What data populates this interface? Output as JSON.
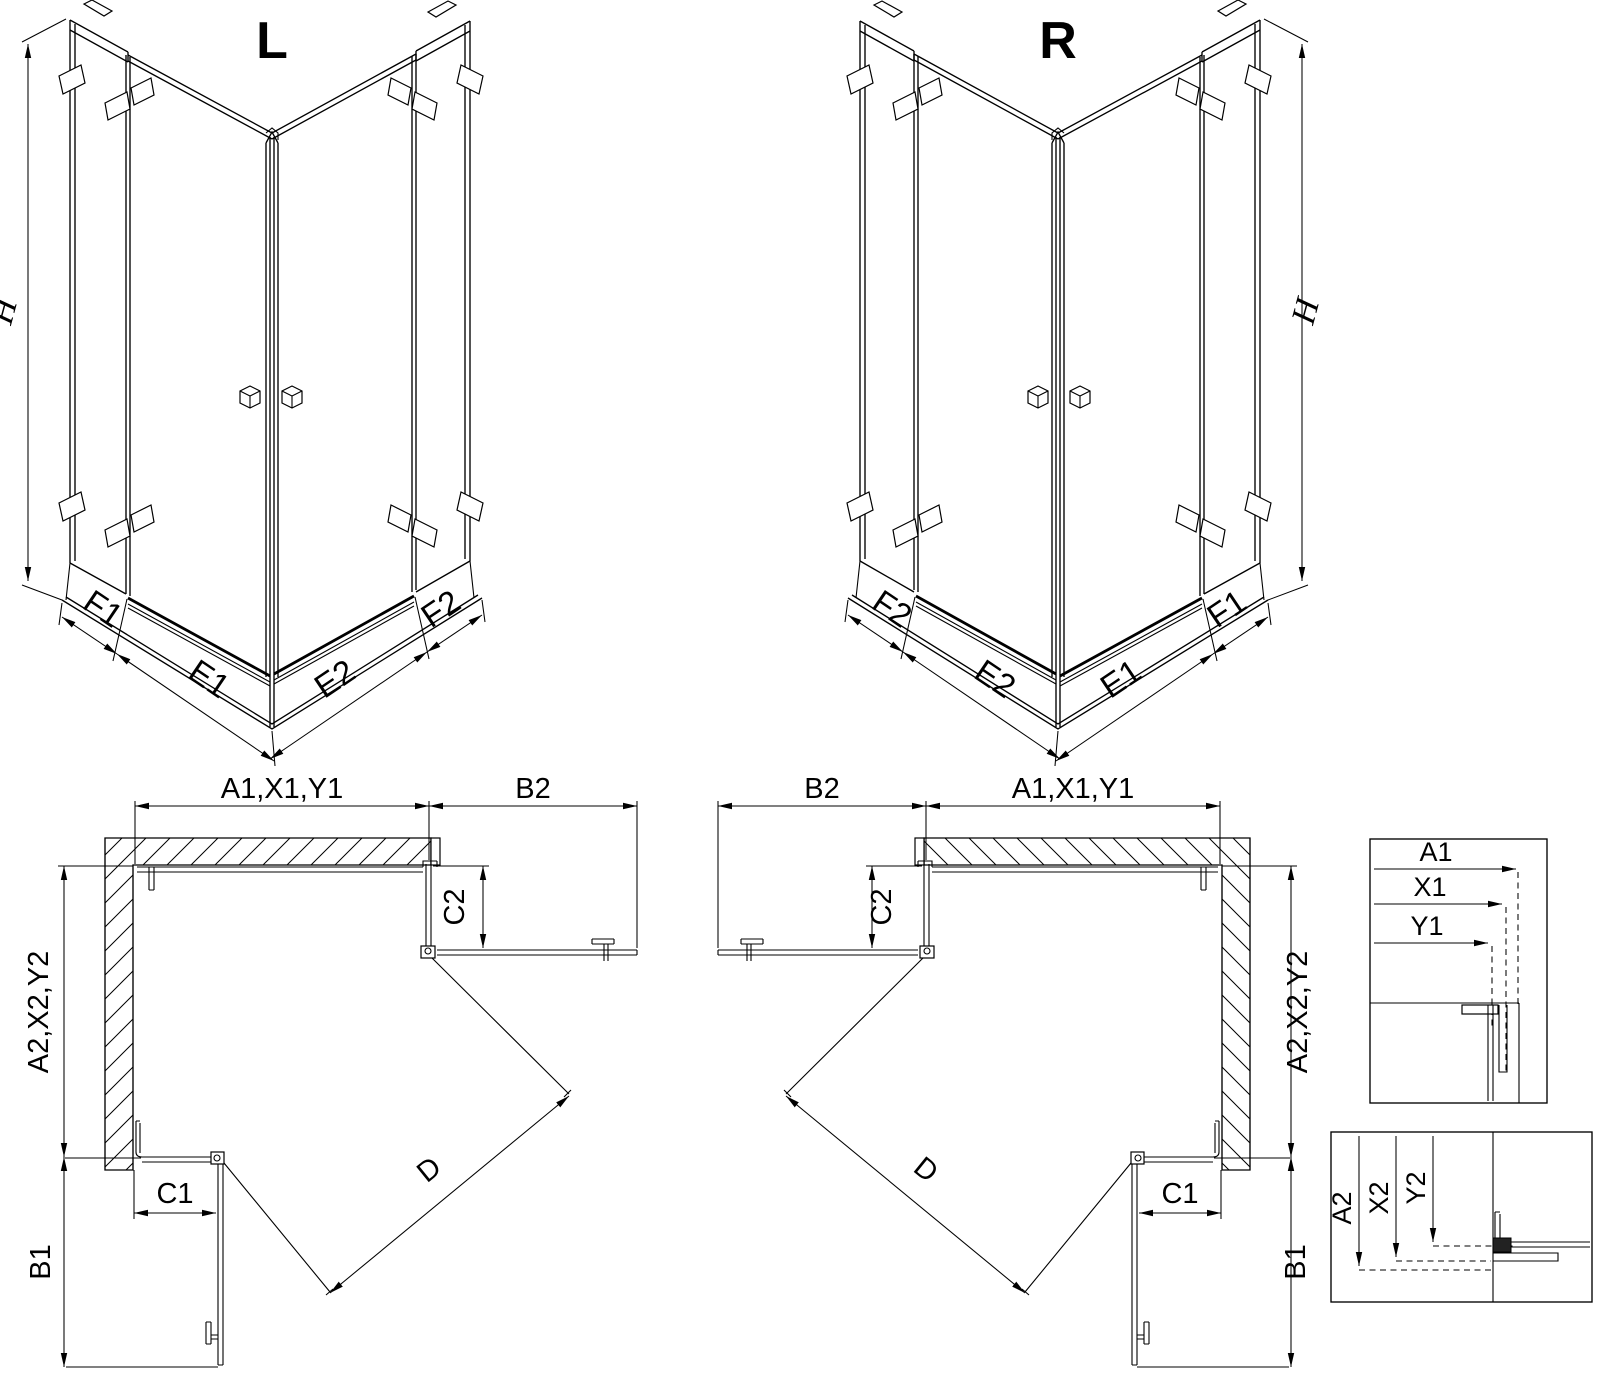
{
  "iso_left": {
    "view_label": "L",
    "height_dim": "H",
    "dim_outer_left": "F1",
    "dim_door_left": "E1",
    "dim_door_right": "E2",
    "dim_outer_right": "F2"
  },
  "iso_right": {
    "view_label": "R",
    "height_dim": "H",
    "dim_outer_left": "F2",
    "dim_door_left": "E2",
    "dim_door_right": "E1",
    "dim_outer_right": "F1"
  },
  "plan_left": {
    "width_dim": "A1,X1,Y1",
    "door_side_dim": "B2",
    "return_side_dim": "C2",
    "depth_dim": "A2,X2,Y2",
    "return_front_dim": "C1",
    "door_front_dim": "B1",
    "entry_dim": "D"
  },
  "plan_right": {
    "width_dim": "A1,X1,Y1",
    "door_side_dim": "B2",
    "return_side_dim": "C2",
    "depth_dim": "A2,X2,Y2",
    "return_front_dim": "C1",
    "door_front_dim": "B1",
    "entry_dim": "D"
  },
  "detail_width": {
    "dims": [
      "A1",
      "X1",
      "Y1"
    ]
  },
  "detail_depth": {
    "dims": [
      "A2",
      "X2",
      "Y2"
    ]
  }
}
